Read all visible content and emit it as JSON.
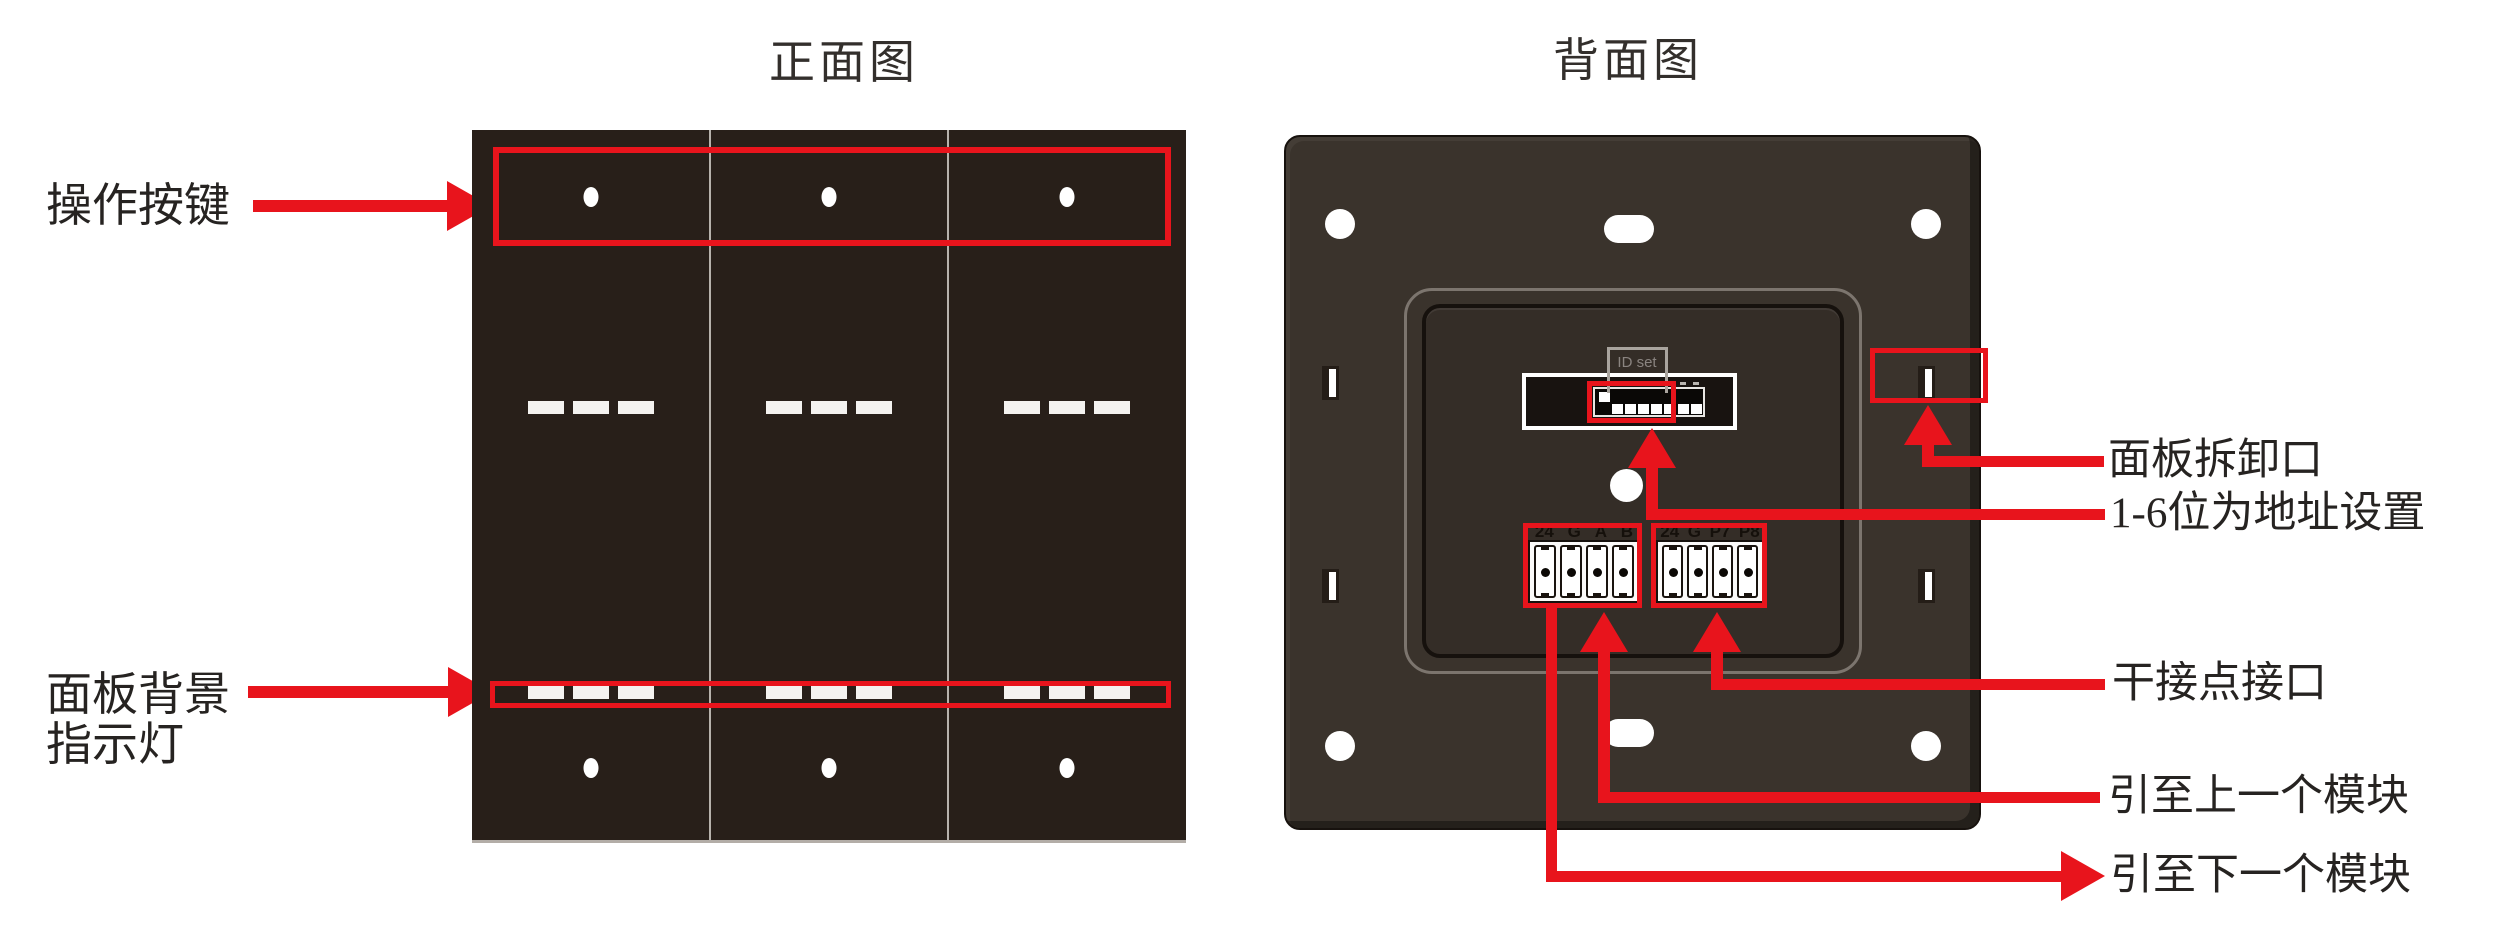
{
  "titles": {
    "front": "正面图",
    "back": "背面图"
  },
  "front": {
    "labels": {
      "operation_buttons": "操作按键",
      "backlight_line1": "面板背景",
      "backlight_line2": "指示灯"
    }
  },
  "back": {
    "dip": {
      "id_set_label": "ID set"
    },
    "terminals": {
      "left": [
        "24",
        "G",
        "A",
        "B"
      ],
      "right": [
        "24",
        "G",
        "P7",
        "P8"
      ]
    },
    "callouts": {
      "removal_port": "面板拆卸口",
      "address_setting": "1-6位为地址设置",
      "dry_contact": "干接点接口",
      "to_previous_module": "引至上一个模块",
      "to_next_module": "引至下一个模块"
    }
  },
  "colors": {
    "annotation_red": "#e8141c",
    "front_panel": "#281f19",
    "back_panel": "#3a332c",
    "recess_fill": "#342d27",
    "label_text": "#262321",
    "idset_gray": "#8a8480"
  }
}
